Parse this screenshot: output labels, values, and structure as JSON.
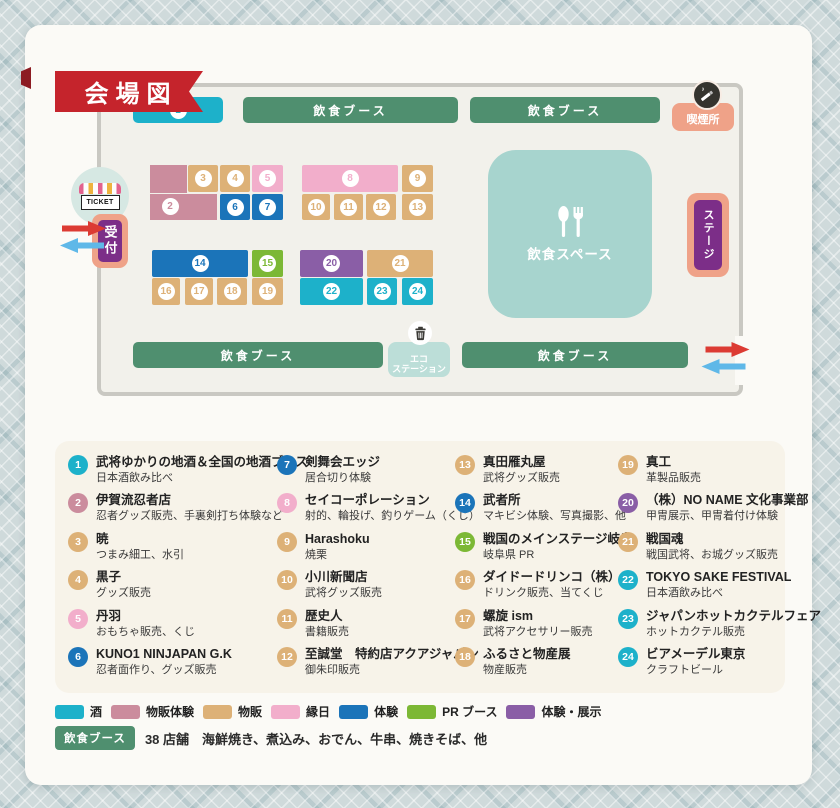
{
  "title": "会場図",
  "colors": {
    "sake": "#1db1ca",
    "goods_exp": "#cb8c9d",
    "goods": "#ddb177",
    "ennichi": "#f2aecb",
    "taiken": "#1b74b9",
    "pr": "#7cb835",
    "tenji": "#8a5ea6",
    "food": "#4f8f6f",
    "arrow_red": "#dc3b33",
    "arrow_blue": "#5fb8e8"
  },
  "map": {
    "food_booth_label": "飲食ブース",
    "smoking": "喫煙所",
    "ticket": "TICKET",
    "reception": "受付",
    "stage": "ステージ",
    "dining": "飲食スペース",
    "eco_line1": "エコ",
    "eco_line2": "ステーション"
  },
  "legend": {
    "items": [
      {
        "num": 1,
        "cat": "sake",
        "name": "武将ゆかりの地酒＆全国の地酒ブース",
        "desc": "日本酒飲み比べ"
      },
      {
        "num": 2,
        "cat": "goods_exp",
        "name": "伊賀流忍者店",
        "desc": "忍者グッズ販売、手裏剣打ち体験など"
      },
      {
        "num": 3,
        "cat": "goods",
        "name": "暁",
        "desc": "つまみ細工、水引"
      },
      {
        "num": 4,
        "cat": "goods",
        "name": "黒子",
        "desc": "グッズ販売"
      },
      {
        "num": 5,
        "cat": "ennichi",
        "name": "丹羽",
        "desc": "おもちゃ販売、くじ"
      },
      {
        "num": 6,
        "cat": "taiken",
        "name": "KUNO1 NINJAPAN G.K",
        "desc": "忍者面作り、グッズ販売"
      },
      {
        "num": 7,
        "cat": "taiken",
        "name": "剣舞会エッジ",
        "desc": "居合切り体験"
      },
      {
        "num": 8,
        "cat": "ennichi",
        "name": "セイコーポレーション",
        "desc": "射的、輪投げ、釣りゲーム（くじ）"
      },
      {
        "num": 9,
        "cat": "goods",
        "name": "Harashoku",
        "desc": "焼栗"
      },
      {
        "num": 10,
        "cat": "goods",
        "name": "小川新聞店",
        "desc": "武将グッズ販売"
      },
      {
        "num": 11,
        "cat": "goods",
        "name": "歴史人",
        "desc": "書籍販売"
      },
      {
        "num": 12,
        "cat": "goods",
        "name": "至誠堂　特約店アクアジャパン",
        "desc": "御朱印販売"
      },
      {
        "num": 13,
        "cat": "goods",
        "name": "真田雁丸屋",
        "desc": "武将グッズ販売"
      },
      {
        "num": 14,
        "cat": "taiken",
        "name": "武者所",
        "desc": "マキビシ体験、写真撮影、他"
      },
      {
        "num": 15,
        "cat": "pr",
        "name": "戦国のメインステージ岐阜",
        "desc": "岐阜県 PR"
      },
      {
        "num": 16,
        "cat": "goods",
        "name": "ダイドードリンコ（株）",
        "desc": "ドリンク販売、当てくじ"
      },
      {
        "num": 17,
        "cat": "goods",
        "name": "螺旋 ism",
        "desc": "武将アクセサリー販売"
      },
      {
        "num": 18,
        "cat": "goods",
        "name": "ふるさと物産展",
        "desc": "物産販売"
      },
      {
        "num": 19,
        "cat": "goods",
        "name": "真工",
        "desc": "革製品販売"
      },
      {
        "num": 20,
        "cat": "tenji",
        "name": "（株）NO NAME 文化事業部",
        "desc": "甲冑展示、甲冑着付け体験"
      },
      {
        "num": 21,
        "cat": "goods",
        "name": "戦国魂",
        "desc": "戦国武将、お城グッズ販売"
      },
      {
        "num": 22,
        "cat": "sake",
        "name": "TOKYO SAKE FESTIVAL",
        "desc": "日本酒飲み比べ"
      },
      {
        "num": 23,
        "cat": "sake",
        "name": "ジャパンホットカクテルフェア",
        "desc": "ホットカクテル販売"
      },
      {
        "num": 24,
        "cat": "sake",
        "name": "ビアメーデル東京",
        "desc": "クラフトビール"
      }
    ]
  },
  "category_key": [
    {
      "label": "酒",
      "cat": "sake"
    },
    {
      "label": "物販体験",
      "cat": "goods_exp"
    },
    {
      "label": "物販",
      "cat": "goods"
    },
    {
      "label": "縁日",
      "cat": "ennichi"
    },
    {
      "label": "体験",
      "cat": "taiken"
    },
    {
      "label": "PR ブース",
      "cat": "pr"
    },
    {
      "label": "体験・展示",
      "cat": "tenji"
    }
  ],
  "food_note": {
    "badge": "飲食ブース",
    "text": "38 店舗　海鮮焼き、煮込み、おでん、牛串、焼きそば、他"
  }
}
